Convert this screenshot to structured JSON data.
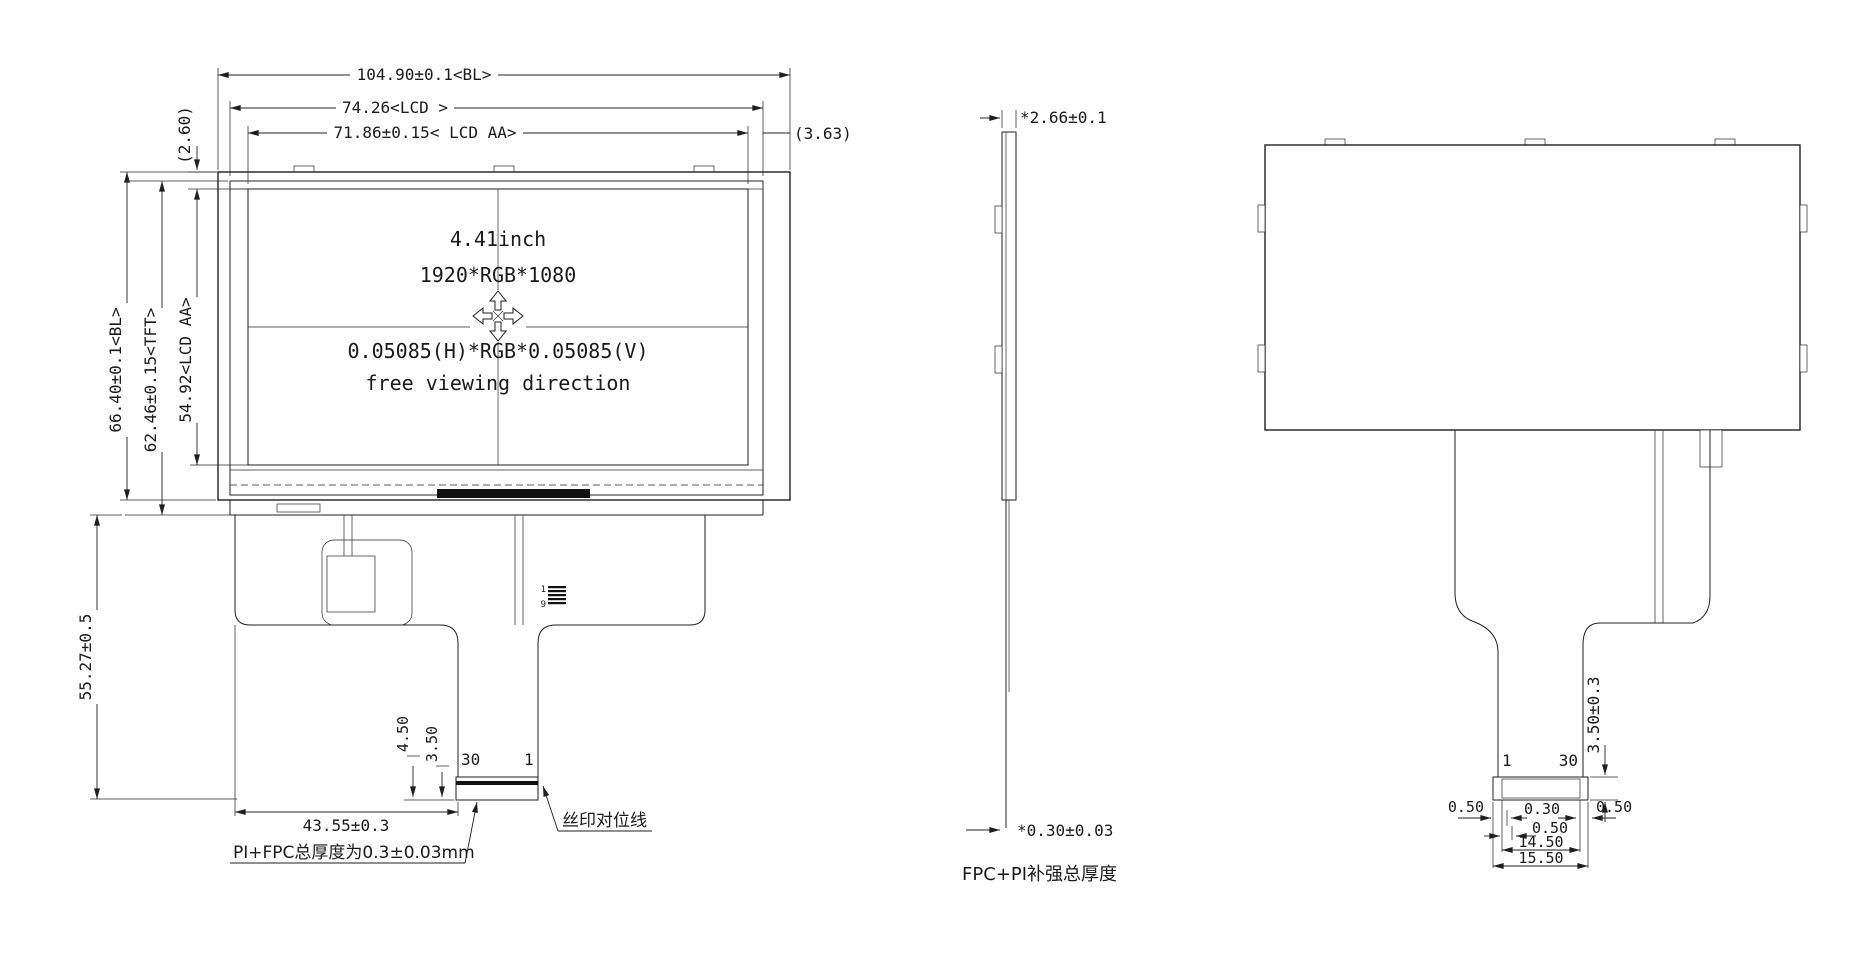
{
  "front_view": {
    "dim_bl_width": "104.90±0.1<BL>",
    "dim_lcd_width": "74.26<LCD >",
    "dim_aa_width": "71.86±0.15< LCD AA>",
    "dim_right_gap": "(3.63)",
    "dim_top_gap": "(2.60)",
    "dim_bl_height": "66.40±0.1<BL>",
    "dim_tft_height": "62.46±0.15<TFT>",
    "dim_aa_height": "54.92<LCD AA>",
    "dim_fpc_length": "55.27±0.5",
    "dim_tail_offset": "43.55±0.3",
    "dim_pad_a": "4.50",
    "dim_pad_b": "3.50",
    "screen_size": "4.41inch",
    "screen_resolution": "1920*RGB*1080",
    "screen_pixel_pitch": "0.05085(H)*RGB*0.05085(V)",
    "screen_viewing": "free viewing direction",
    "pin_left": "30",
    "pin_right": "1",
    "pad_first": "1",
    "pad_last": "9",
    "note_silkscreen": "丝印对位线",
    "note_fpc_thickness": "PI+FPC总厚度为0.3±0.03mm"
  },
  "side_view": {
    "dim_total_thickness": "*2.66±0.1",
    "dim_fpc_thickness": "*0.30±0.03",
    "label_fpc": "FPC+PI补强总厚度"
  },
  "back_view": {
    "pin_left": "1",
    "pin_right": "30",
    "dim_stiffener": "3.50±0.3",
    "dim_margin_left": "0.50",
    "dim_pin_width": "0.30",
    "dim_margin_right": "0.50",
    "dim_pin_pitch": "0.50",
    "dim_pin_span": "14.50",
    "dim_connector_width": "15.50"
  },
  "colors": {
    "line": "#1f1f1f",
    "background": "#ffffff"
  }
}
